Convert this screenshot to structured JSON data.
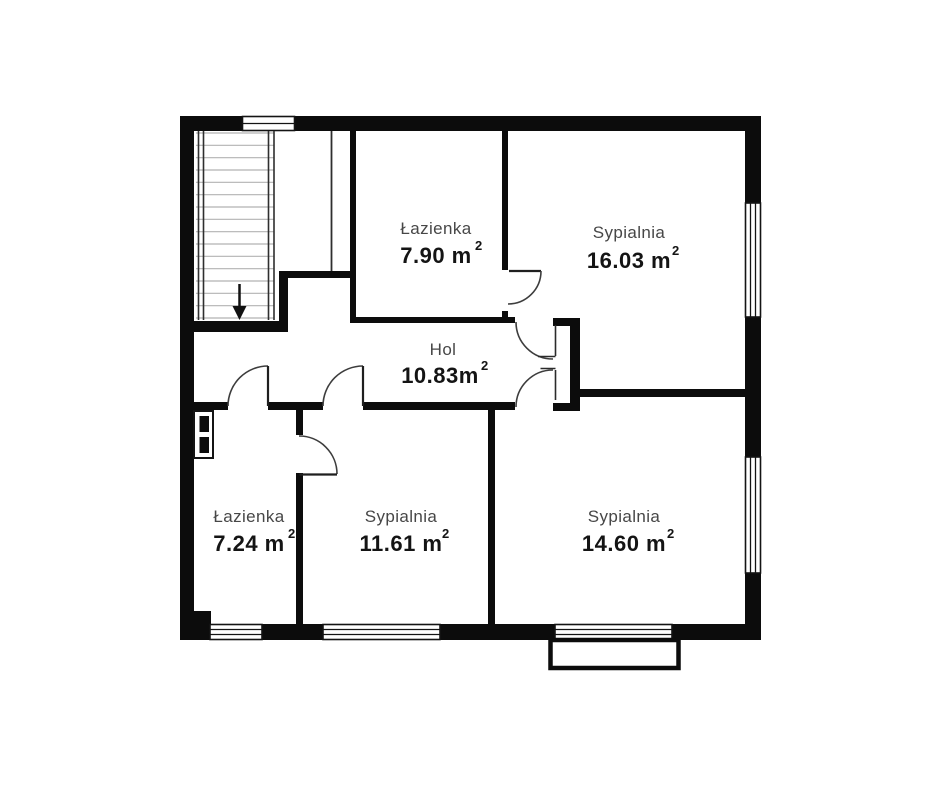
{
  "plan": {
    "rooms": [
      {
        "id": "bathroom-upper",
        "name": "Łazienka",
        "area": "7.90 m",
        "sup": "2"
      },
      {
        "id": "bedroom-upper-right",
        "name": "Sypialnia",
        "area": "16.03 m",
        "sup": "2"
      },
      {
        "id": "hall",
        "name": "Hol",
        "area": "10.83m",
        "sup": "2"
      },
      {
        "id": "bathroom-lower",
        "name": "Łazienka",
        "area": "7.24 m",
        "sup": "2"
      },
      {
        "id": "bedroom-middle",
        "name": "Sypialnia",
        "area": "11.61 m",
        "sup": "2"
      },
      {
        "id": "bedroom-lower-right",
        "name": "Sypialnia",
        "area": "14.60 m",
        "sup": "2"
      }
    ],
    "colors": {
      "wall": "#0c0c0c",
      "room_name": "#474747",
      "room_area": "#141414",
      "door_arc": "#3d3d3d",
      "stair_tread": "#b2b2b2",
      "background": "#ffffff"
    }
  }
}
